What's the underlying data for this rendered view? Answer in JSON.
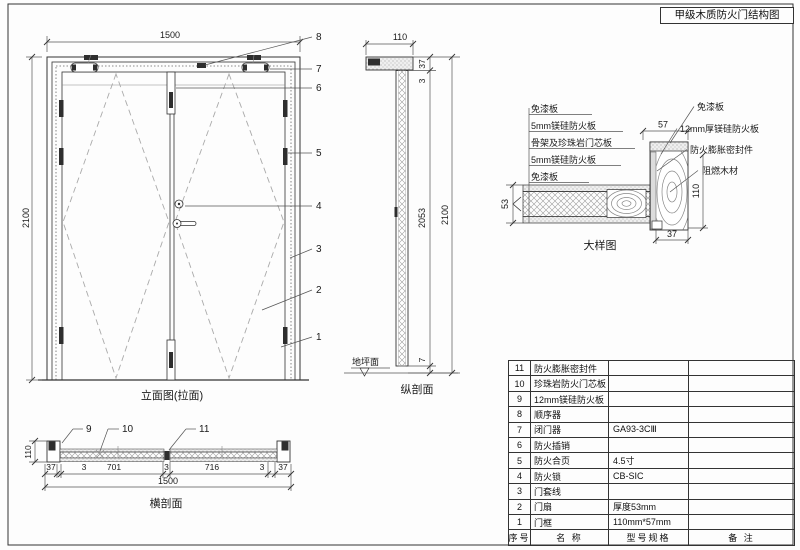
{
  "title": "甲级木质防火门结构图",
  "views": {
    "elevation": {
      "label": "立面图(拉面)",
      "dims": {
        "width": "1500",
        "height": "2100"
      },
      "callouts": [
        "1",
        "2",
        "3",
        "4",
        "5",
        "6",
        "7",
        "8"
      ]
    },
    "vsection": {
      "label": "纵剖面",
      "floor_label": "地坪面",
      "dims": {
        "frame_width": "110",
        "head": "37",
        "top_gap": "3",
        "leaf_height": "2053",
        "bottom_gap": "7",
        "total": "2100"
      }
    },
    "hsection": {
      "label": "横剖面",
      "callouts": [
        "9",
        "10",
        "11"
      ],
      "dims": {
        "depth": "110",
        "chain": [
          "37",
          "3",
          "701",
          "3",
          "716",
          "3",
          "37"
        ],
        "total": "1500"
      }
    },
    "detail": {
      "label": "大样图",
      "layer_labels": [
        "免漆板",
        "5mm镁硅防火板",
        "骨架及珍珠岩门芯板",
        "5mm镁硅防火板",
        "免漆板"
      ],
      "part_labels": [
        "免漆板",
        "12mm厚镁硅防火板",
        "防火膨胀密封件",
        "阻燃木材"
      ],
      "dims": {
        "frame_face": "57",
        "leaf_thickness": "53",
        "frame_depth": "110",
        "stop": "37"
      }
    }
  },
  "table": {
    "headers": {
      "no": "序号",
      "name": "名 称",
      "spec": "型号规格",
      "remark": "备 注"
    },
    "rows": [
      {
        "no": "11",
        "name": "防火膨胀密封件",
        "spec": "",
        "remark": ""
      },
      {
        "no": "10",
        "name": "珍珠岩防火门芯板",
        "spec": "",
        "remark": ""
      },
      {
        "no": "9",
        "name": "12mm镁硅防火板",
        "spec": "",
        "remark": ""
      },
      {
        "no": "8",
        "name": "顺序器",
        "spec": "",
        "remark": ""
      },
      {
        "no": "7",
        "name": "闭门器",
        "spec": "GA93-3CⅢ",
        "remark": ""
      },
      {
        "no": "6",
        "name": "防火插销",
        "spec": "",
        "remark": ""
      },
      {
        "no": "5",
        "name": "防火合页",
        "spec": "4.5寸",
        "remark": ""
      },
      {
        "no": "4",
        "name": "防火锁",
        "spec": "CB-SIC",
        "remark": ""
      },
      {
        "no": "3",
        "name": "门套线",
        "spec": "",
        "remark": ""
      },
      {
        "no": "2",
        "name": "门扇",
        "spec": "厚度53mm",
        "remark": ""
      },
      {
        "no": "1",
        "name": "门框",
        "spec": "110mm*57mm",
        "remark": ""
      }
    ]
  }
}
